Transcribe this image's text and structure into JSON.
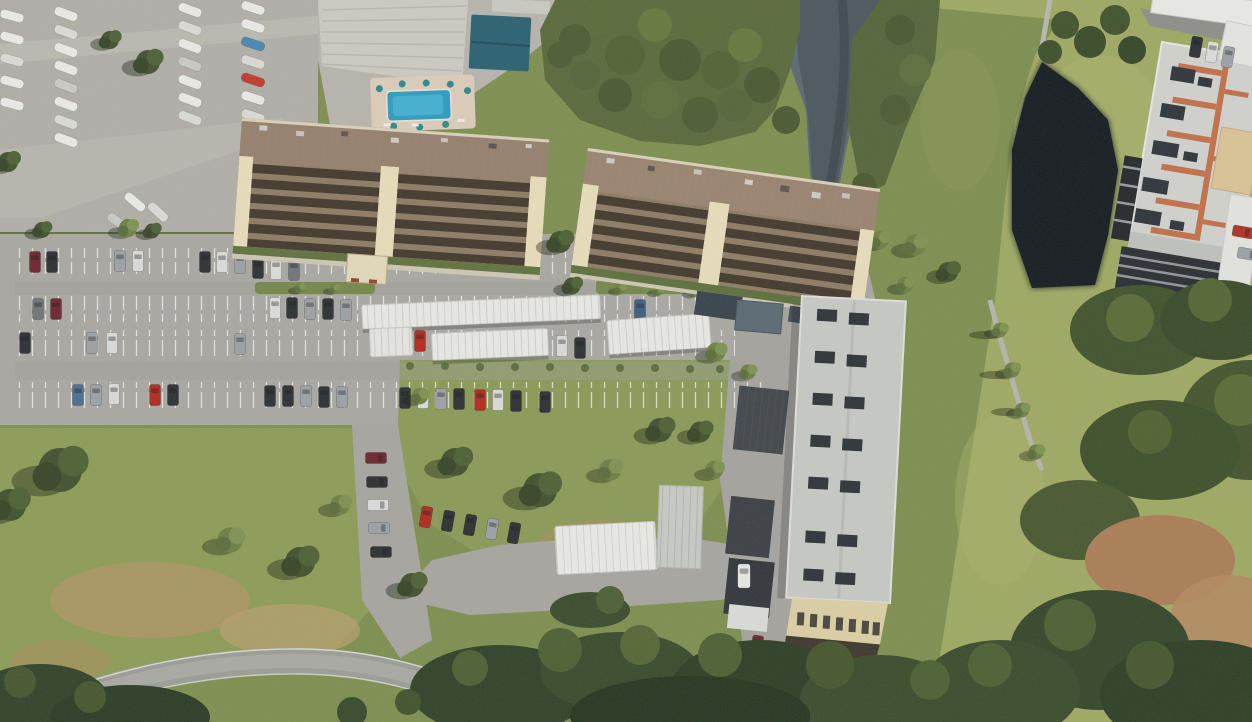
{
  "map": {
    "imagery": "satellite-aerial-oblique",
    "watermark": "Google",
    "street": {
      "name": "Cove Cay Dr"
    },
    "buildings": [
      {
        "id": "800",
        "label": "800"
      },
      {
        "id": "900",
        "label": "900"
      },
      {
        "id": "1000",
        "label": "1000"
      }
    ],
    "communities": [
      {
        "id": "village-3",
        "line1": "COVE CAY",
        "line2": "VILLAGE III"
      },
      {
        "id": "village-4",
        "line1": "COVE",
        "line2": "CAY",
        "line3": "VILLAGE IV"
      }
    ],
    "colors": {
      "label": "#FFFF00",
      "street_label": "#FFFFFF",
      "watermark": "#FFFFFF"
    }
  }
}
